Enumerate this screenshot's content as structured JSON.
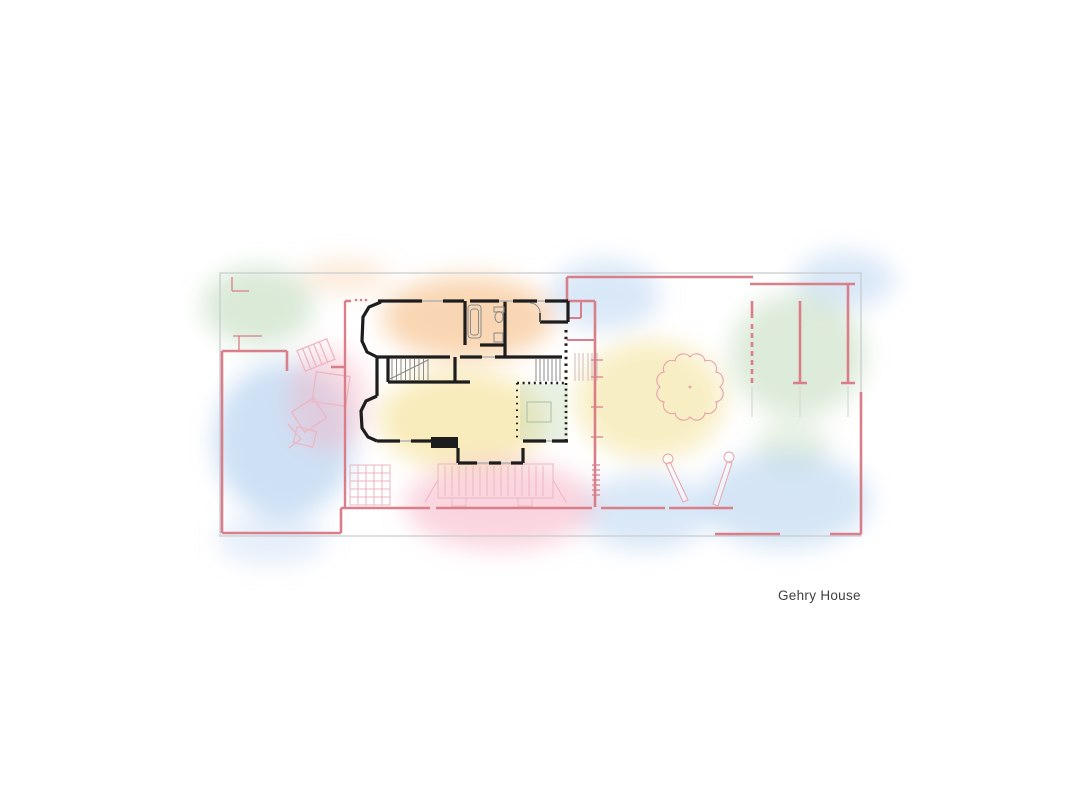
{
  "page": {
    "background": "#ffffff",
    "label": "Gehry House"
  },
  "palette": {
    "blue": "#abcbee",
    "green": "#bcd8b6",
    "yellow": "#f3e093",
    "orange": "#f5bb80",
    "pink": "#f5b3c4",
    "wall_pink": "#d87f89",
    "wall_black": "#1d1d1d",
    "boundary_gray": "#c6cacd",
    "tree_pink": "#e8a3ac",
    "detail_pink": "#edb6c1",
    "fixture_gray": "#8a8a8a",
    "label_color": "#3f3f3f"
  }
}
